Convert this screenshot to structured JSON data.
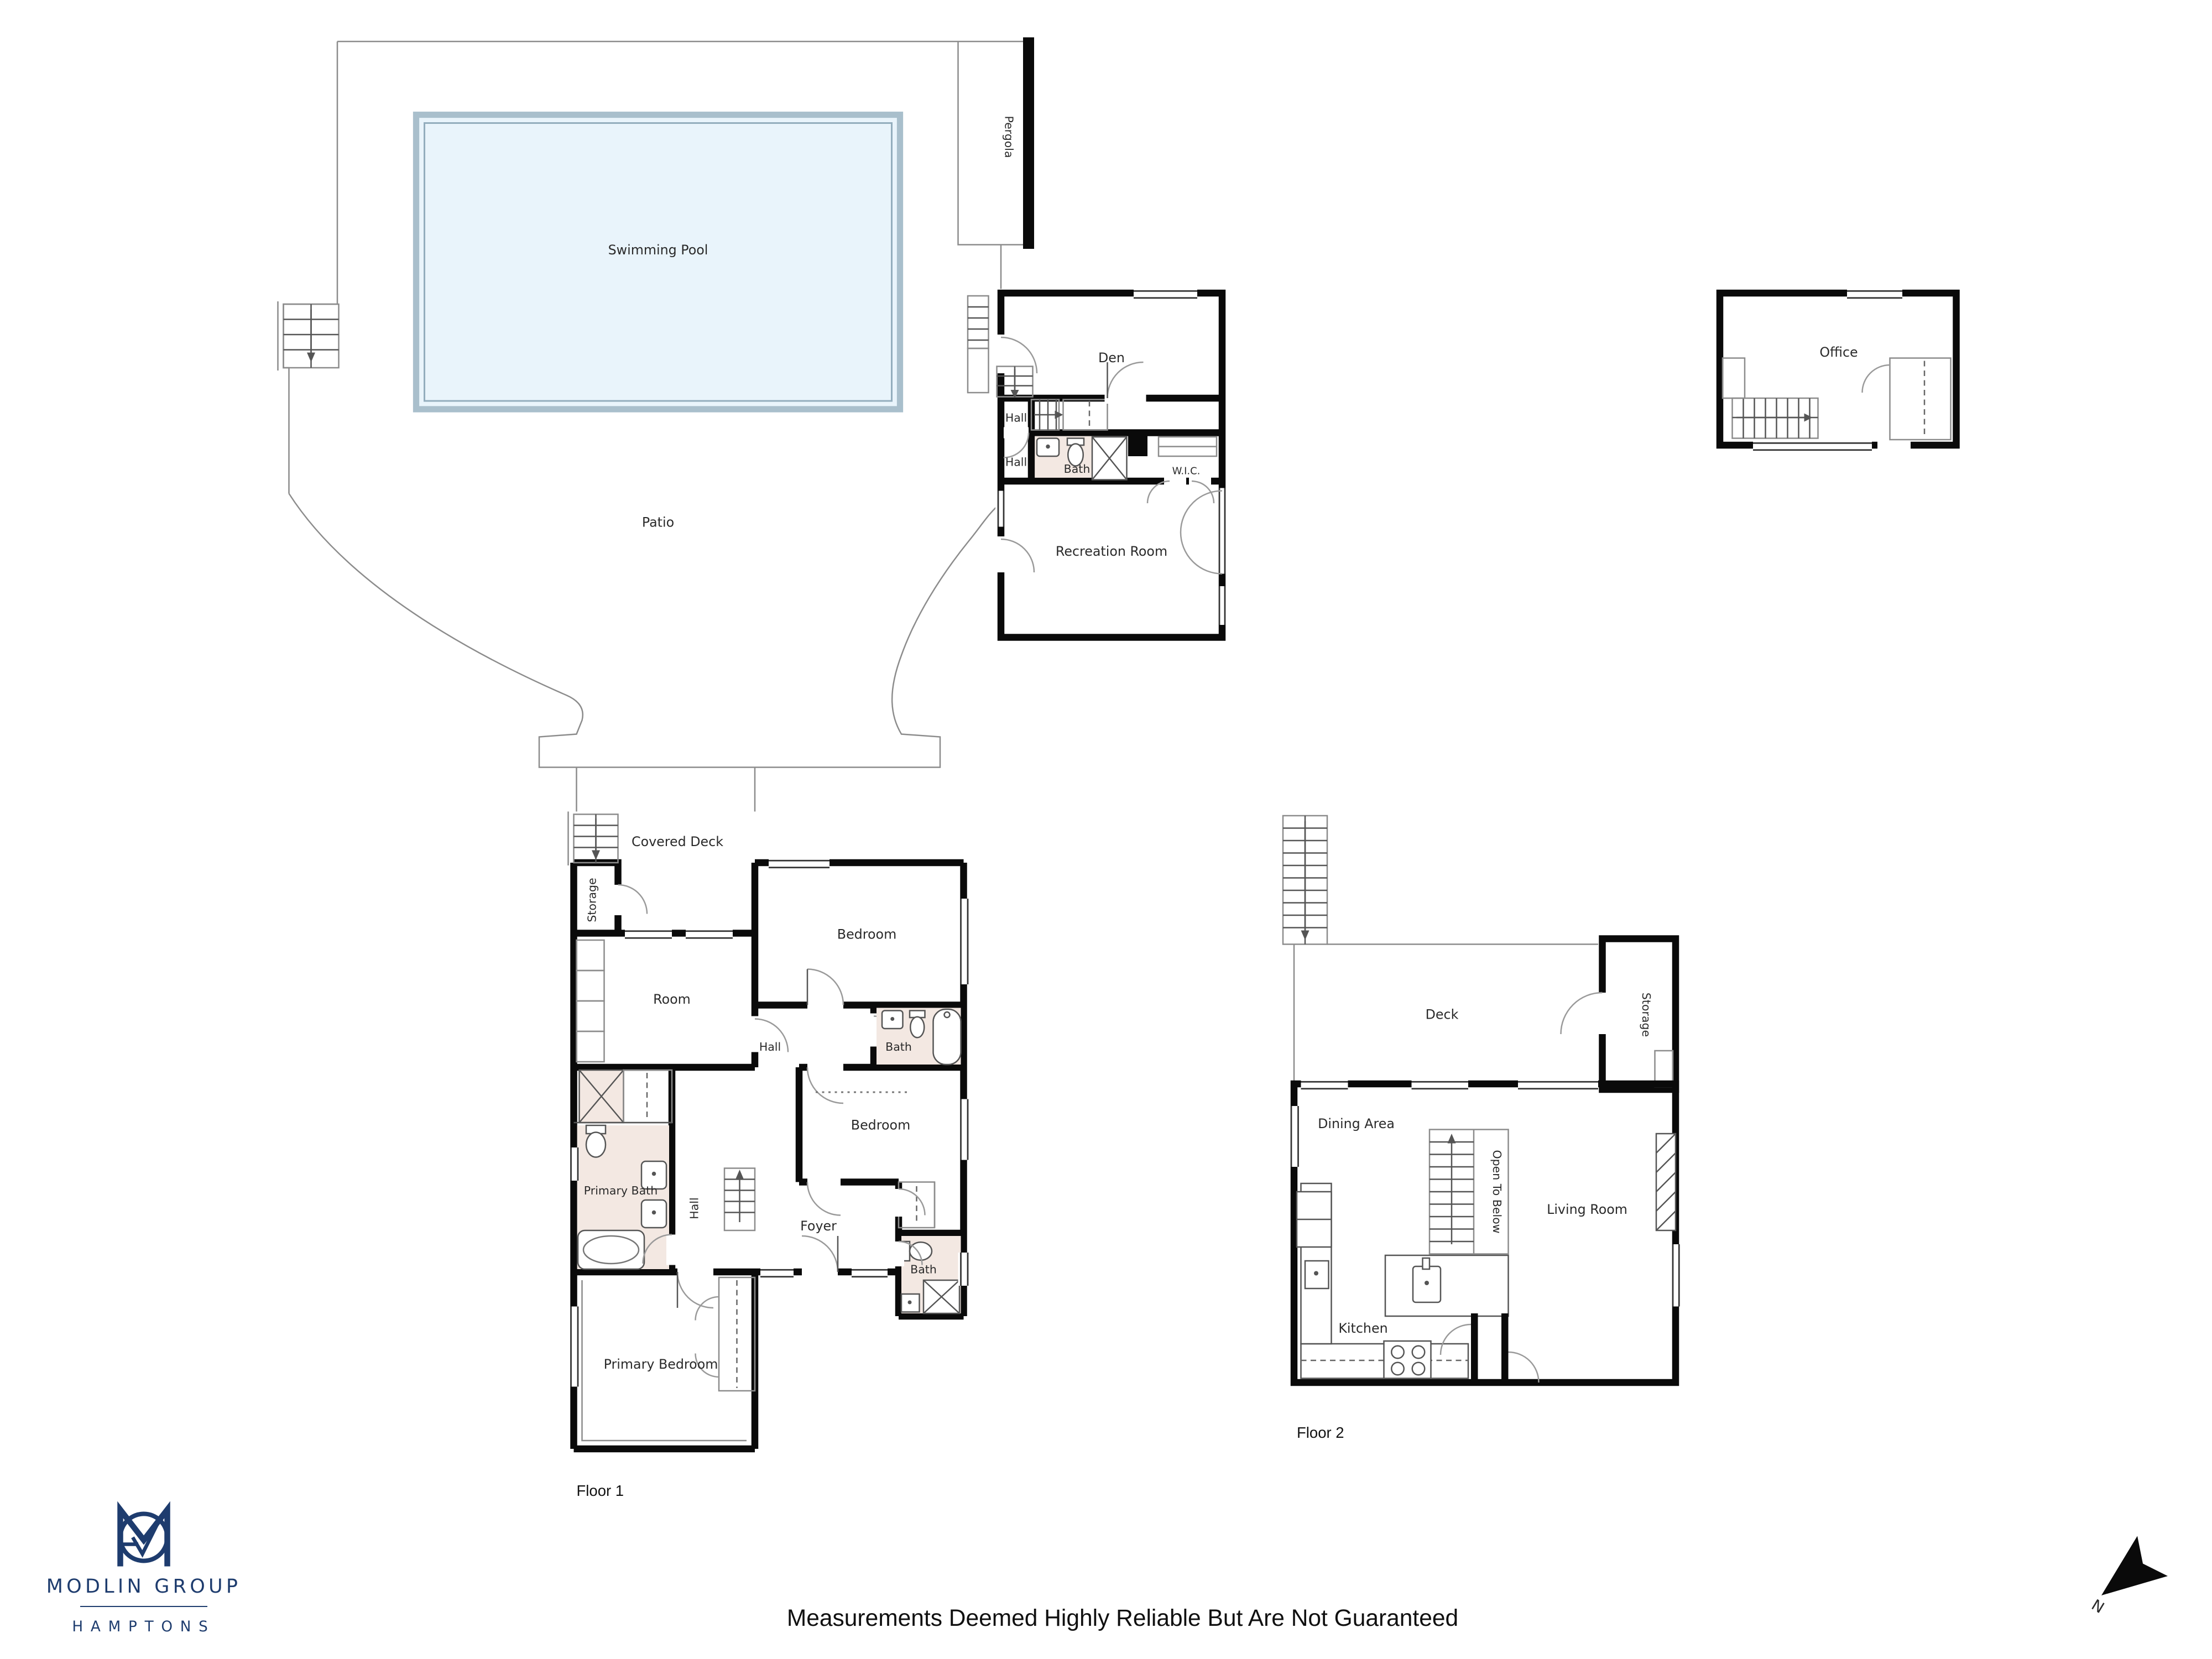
{
  "pool_area": {
    "swimming_pool": "Swimming Pool",
    "pergola": "Pergola",
    "patio": "Patio"
  },
  "lower_level": {
    "den": "Den",
    "hall_upper": "Hall",
    "hall_lower": "Hall",
    "bath": "Bath",
    "wic": "W.I.C.",
    "recreation_room": "Recreation Room"
  },
  "office": {
    "label": "Office"
  },
  "floor1": {
    "covered_deck": "Covered Deck",
    "storage": "Storage",
    "room": "Room",
    "bedroom_upper": "Bedroom",
    "hall": "Hall",
    "bath_upper": "Bath",
    "bedroom_lower": "Bedroom",
    "primary_bath": "Primary Bath",
    "hall_lower": "Hall",
    "foyer": "Foyer",
    "bath_lower": "Bath",
    "primary_bedroom": "Primary Bedroom",
    "label": "Floor 1"
  },
  "floor2": {
    "deck": "Deck",
    "storage": "Storage",
    "dining_area": "Dining Area",
    "open_to_below": "Open To Below",
    "living_room": "Living Room",
    "kitchen": "Kitchen",
    "label": "Floor 2"
  },
  "branding": {
    "company": "MODLIN GROUP",
    "region": "HAMPTONS"
  },
  "compass": {
    "north": "N"
  },
  "footer": {
    "disclaimer": "Measurements Deemed Highly Reliable But Are Not Guaranteed"
  },
  "colors": {
    "wall": "#0a0a0a",
    "bath_fill": "#f3e8e2",
    "pool_fill": "#e9f4fb",
    "logo_navy": "#1e3c6e"
  }
}
